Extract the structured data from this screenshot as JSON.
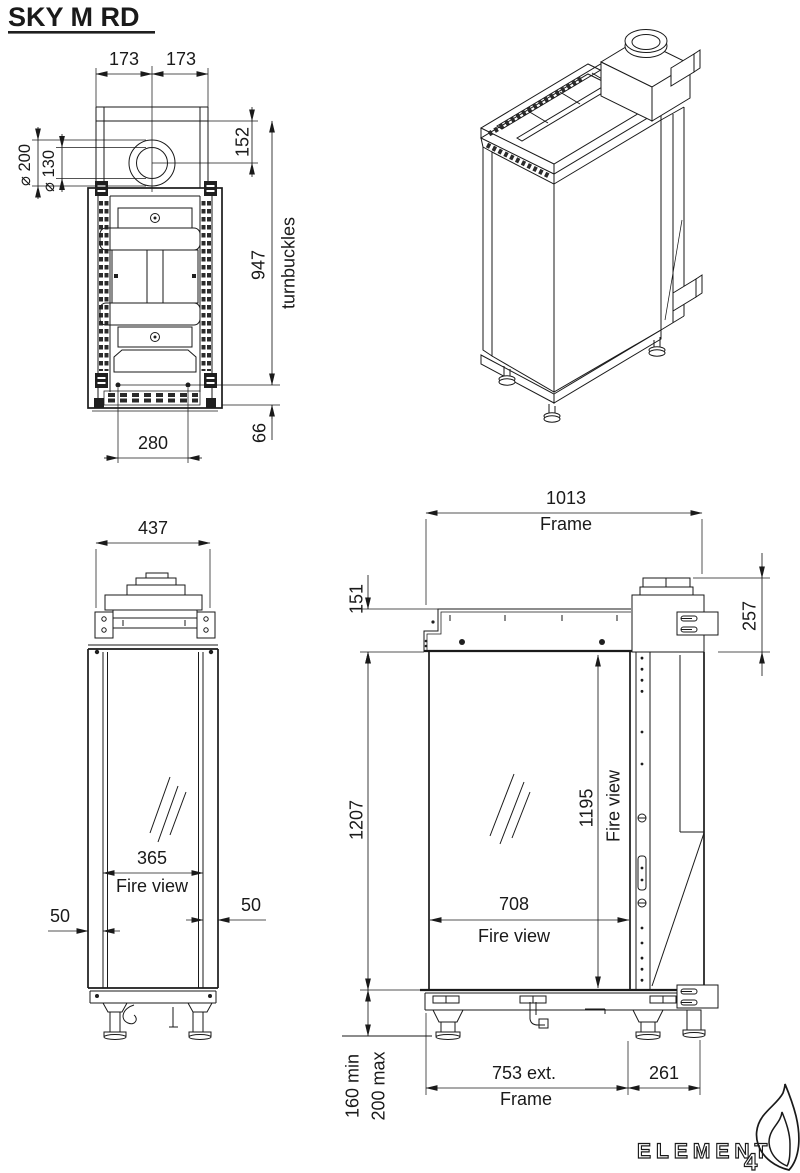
{
  "title": "SKY M RD",
  "top_view": {
    "d173l": "173",
    "d173r": "173",
    "d152": "152",
    "d200": "⌀ 200",
    "d130": "⌀ 130",
    "d947": "947",
    "turnbuckles": "turnbuckles",
    "d280": "280",
    "d66": "66"
  },
  "front_view": {
    "d437": "437",
    "d365": "365",
    "fire_view": "Fire view",
    "d50l": "50",
    "d50r": "50"
  },
  "side_view": {
    "d1013": "1013",
    "frame_top": "Frame",
    "d151": "151",
    "d257": "257",
    "d1207": "1207",
    "d1195": "1195",
    "fire_view_v": "Fire view",
    "d708": "708",
    "fire_view_h": "Fire view",
    "d753": "753 ext.",
    "frame_bottom": "Frame",
    "d261": "261",
    "d160min": "160 min",
    "d200max": "200 max"
  },
  "logo": {
    "brand": "ELEMENT",
    "number": "4"
  }
}
